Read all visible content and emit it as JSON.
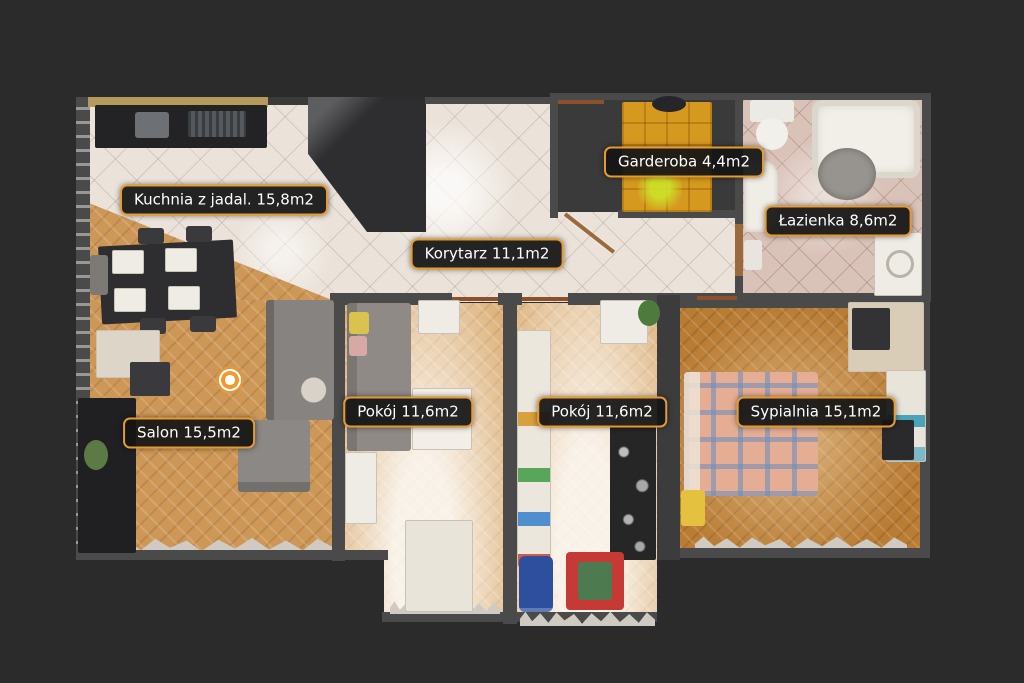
{
  "view": {
    "type": "floorplan-top-view",
    "background_color": "#2b2b2c"
  },
  "theme": {
    "label_background": "#141414",
    "label_border": "#e59b2f",
    "label_text": "#ffffff",
    "wall_color": "#4a4a4b",
    "marker_color": "#f2992e"
  },
  "rooms": [
    {
      "id": "kuchnia",
      "label": "Kuchnia z jadal. 15,8m2"
    },
    {
      "id": "korytarz",
      "label": "Korytarz 11,1m2"
    },
    {
      "id": "garderoba",
      "label": "Garderoba 4,4m2"
    },
    {
      "id": "lazienka",
      "label": "Łazienka 8,6m2"
    },
    {
      "id": "pokoj1",
      "label": "Pokój 11,6m2"
    },
    {
      "id": "pokoj2",
      "label": "Pokój 11,6m2"
    },
    {
      "id": "sypialnia",
      "label": "Sypialnia 15,1m2"
    },
    {
      "id": "salon",
      "label": "Salon 15,5m2"
    }
  ],
  "marker": {
    "type": "camera-viewpoint"
  }
}
